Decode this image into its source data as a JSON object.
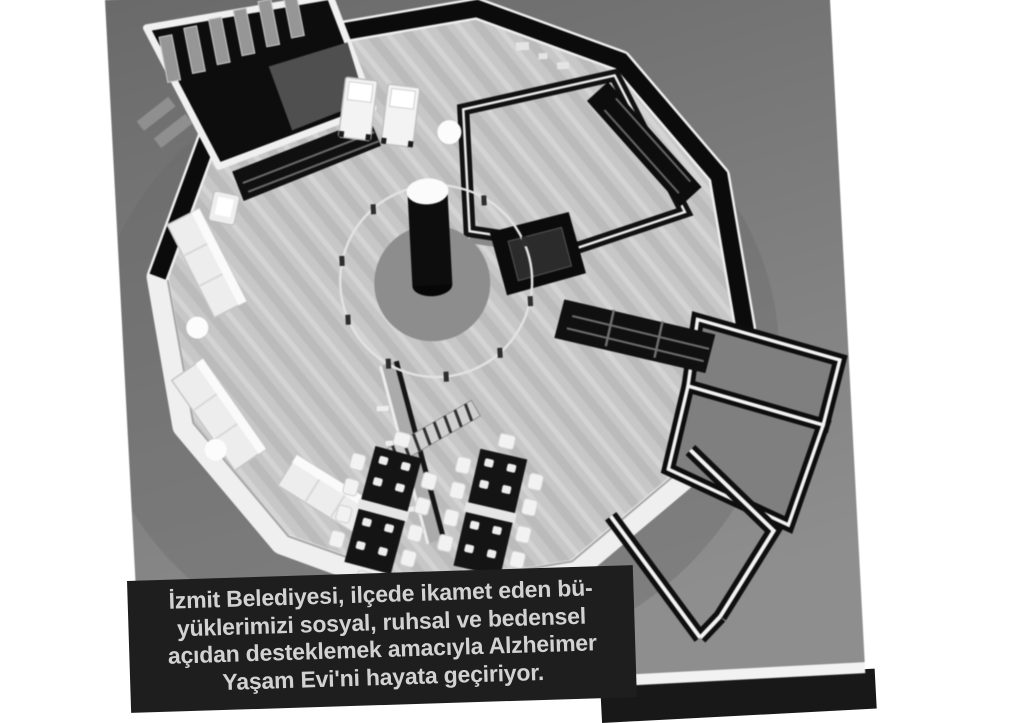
{
  "caption": {
    "lines": [
      "İzmit Belediyesi, ilçede ikamet eden bü-",
      "yüklerimizi sosyal, ruhsal ve bedensel",
      "açıdan desteklemek amacıyla Alzheimer",
      "Yaşam Evi'ni hayata geçiriyor."
    ],
    "background": "#1e1e1e",
    "text_color": "#d2d2d2"
  },
  "photo": {
    "kind": "grayscale 3D aerial rendering",
    "subject": "circular single-storey care home floor plan with rooms around a central column",
    "background_gray_top": "#6a6a6a",
    "background_gray_bottom": "#8e8e8e",
    "floor_color": "#c7c7c7",
    "wall_top_color": "#0c0c0c",
    "wall_trim_color": "#f0f0f0",
    "furniture_color": "#efefef",
    "table_color": "#141414"
  },
  "scene_elements": {
    "library_annex": "rectangular room with shelving, upper left",
    "right_annex": "open-roof rooms, right side",
    "entrance_corridor": "angled corridor, lower right",
    "central_column": "black cylinder with white top on round rug with circular railing",
    "dining_sets": "two double tables with white chairs and place settings",
    "sofas": "white sofas along left outer wall",
    "beds": "two white beds against upper black wall",
    "floor_lights": "round white lights on floor"
  }
}
